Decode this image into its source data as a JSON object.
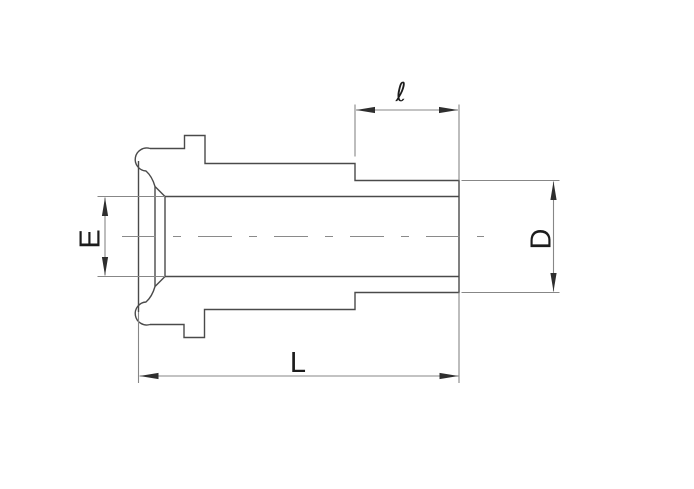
{
  "drawing": {
    "background_color": "#ffffff",
    "outline_color": "#4a4a4a",
    "dimension_line_color": "#878787",
    "label_color": "#1c1c1c",
    "labels": {
      "stub_length": "ℓ",
      "bore_diameter": "E",
      "outer_diameter": "D",
      "overall_length": "L"
    }
  }
}
